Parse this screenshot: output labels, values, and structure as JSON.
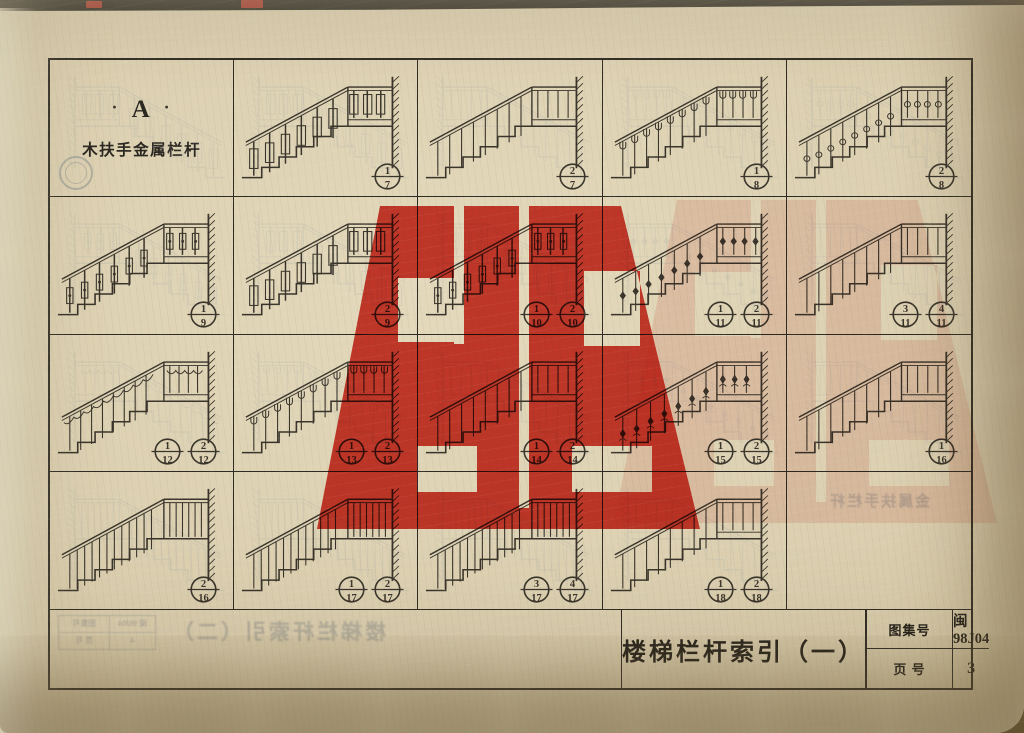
{
  "section": {
    "dot": "·",
    "letter": "A",
    "name": "木扶手金属栏杆"
  },
  "title_block": {
    "title": "楼梯栏杆索引（一）",
    "atlas_label": "图集号",
    "atlas_value": "闽 98J04",
    "page_label": "页 号",
    "page_value": "3"
  },
  "ghosts": {
    "mirrored_title": "楼梯栏杆索引（二）",
    "mirrored_atlas_label": "图集号",
    "mirrored_atlas_value": "闽 98J04",
    "mirrored_page_label": "页 号",
    "mirrored_page_value": "4",
    "empty_cell_text": "金属扶手栏杆"
  },
  "colors": {
    "paper": "#dbcfb0",
    "line": "#39342b",
    "ghost": "#97a0a6",
    "stamp_red": "#d0251a"
  },
  "grid": {
    "columns": 5,
    "rows": 4,
    "cells": [
      {
        "r": 0,
        "c": 0,
        "type": "label"
      },
      {
        "r": 0,
        "c": 1,
        "type": "drawing",
        "style": "panel",
        "refs": [
          [
            "1",
            "7"
          ]
        ]
      },
      {
        "r": 0,
        "c": 2,
        "type": "drawing",
        "style": "plain",
        "refs": [
          [
            "2",
            "7"
          ]
        ]
      },
      {
        "r": 0,
        "c": 3,
        "type": "drawing",
        "style": "loop",
        "refs": [
          [
            "1",
            "8"
          ]
        ]
      },
      {
        "r": 0,
        "c": 4,
        "type": "drawing",
        "style": "ring",
        "refs": [
          [
            "2",
            "8"
          ]
        ]
      },
      {
        "r": 1,
        "c": 0,
        "type": "drawing",
        "style": "bottle",
        "refs": [
          [
            "1",
            "9"
          ]
        ]
      },
      {
        "r": 1,
        "c": 1,
        "type": "drawing",
        "style": "panel",
        "refs": [
          [
            "2",
            "9"
          ]
        ]
      },
      {
        "r": 1,
        "c": 2,
        "type": "drawing",
        "style": "bottle",
        "refs": [
          [
            "1",
            "10"
          ],
          [
            "2",
            "10"
          ]
        ]
      },
      {
        "r": 1,
        "c": 3,
        "type": "drawing",
        "style": "diamond",
        "refs": [
          [
            "1",
            "11"
          ],
          [
            "2",
            "11"
          ]
        ]
      },
      {
        "r": 1,
        "c": 4,
        "type": "drawing",
        "style": "plain",
        "refs": [
          [
            "3",
            "11"
          ],
          [
            "4",
            "11"
          ]
        ]
      },
      {
        "r": 2,
        "c": 0,
        "type": "drawing",
        "style": "scallop",
        "refs": [
          [
            "1",
            "12"
          ],
          [
            "2",
            "12"
          ]
        ]
      },
      {
        "r": 2,
        "c": 1,
        "type": "drawing",
        "style": "loop",
        "refs": [
          [
            "1",
            "13"
          ],
          [
            "2",
            "13"
          ]
        ]
      },
      {
        "r": 2,
        "c": 2,
        "type": "drawing",
        "style": "plain",
        "refs": [
          [
            "1",
            "14"
          ],
          [
            "2",
            "14"
          ]
        ]
      },
      {
        "r": 2,
        "c": 3,
        "type": "drawing",
        "style": "ornate",
        "refs": [
          [
            "1",
            "15"
          ],
          [
            "2",
            "15"
          ]
        ]
      },
      {
        "r": 2,
        "c": 4,
        "type": "drawing",
        "style": "plain",
        "refs": [
          [
            "1",
            "16"
          ]
        ]
      },
      {
        "r": 3,
        "c": 0,
        "type": "drawing",
        "style": "dense",
        "refs": [
          [
            "2",
            "16"
          ]
        ]
      },
      {
        "r": 3,
        "c": 1,
        "type": "drawing",
        "style": "dense",
        "refs": [
          [
            "1",
            "17"
          ],
          [
            "2",
            "17"
          ]
        ]
      },
      {
        "r": 3,
        "c": 2,
        "type": "drawing",
        "style": "dense",
        "refs": [
          [
            "3",
            "17"
          ],
          [
            "4",
            "17"
          ]
        ]
      },
      {
        "r": 3,
        "c": 3,
        "type": "drawing",
        "style": "plain",
        "refs": [
          [
            "1",
            "18"
          ],
          [
            "2",
            "18"
          ]
        ]
      },
      {
        "r": 3,
        "c": 4,
        "type": "empty"
      }
    ]
  }
}
